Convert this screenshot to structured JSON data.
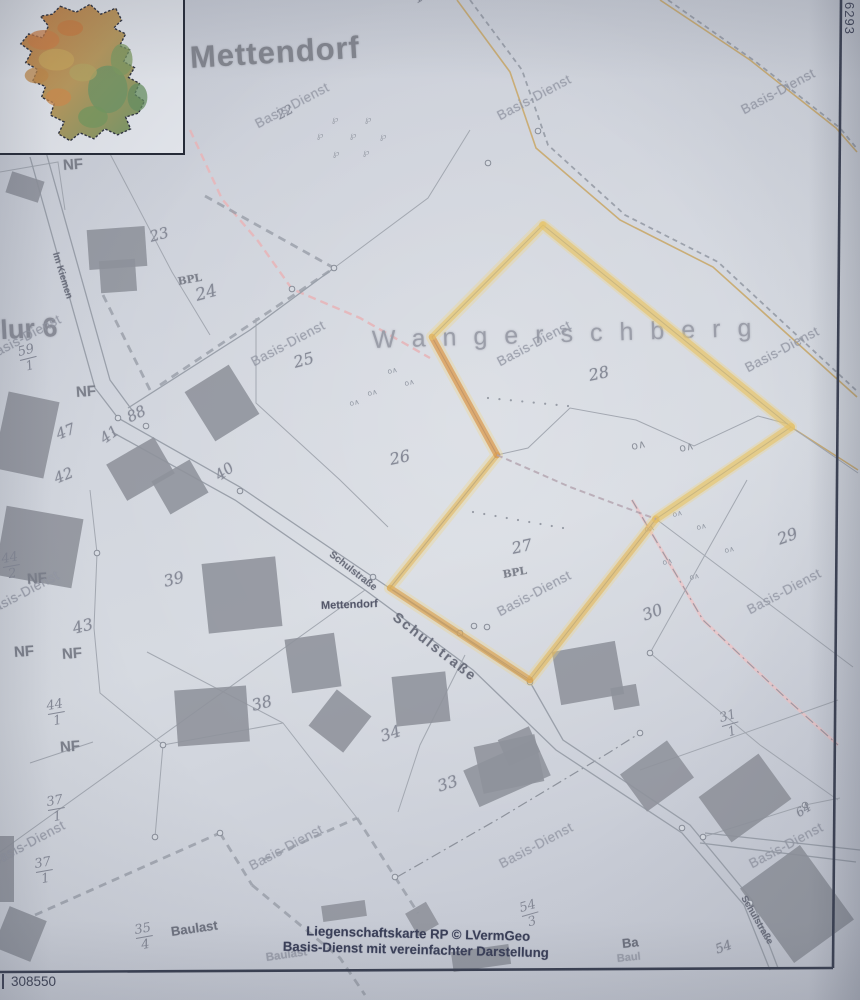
{
  "photo": {
    "width": 860,
    "height": 1000
  },
  "coords": {
    "bottom_left": "308550",
    "top_right": "6293"
  },
  "caption": {
    "line1": "Liegenschaftskarte RP © LVermGeo",
    "line2": "Basis-Dienst mit vereinfachter Darstellung"
  },
  "colors": {
    "paper": "#d2d6de",
    "frame": "#3a4052",
    "print": "#a3a8b1",
    "road": "#9aa0aa",
    "building": "#8e929b",
    "highlight_yellow": "#e7c468",
    "highlight_orange": "#d89044",
    "pink": "#ecc3c6",
    "tan": "#c9a86a",
    "caption_ink": "#3a3f58"
  },
  "labels": [
    {
      "t": "Mettendorf",
      "x": 190,
      "y": 42,
      "s": 31,
      "r": -3.5,
      "c": "title"
    },
    {
      "t": "Wangerschberg",
      "x": 372,
      "y": 328,
      "s": 25,
      "r": -1.8,
      "c": "area",
      "ls": 17
    },
    {
      "t": "Flur 6",
      "x": -16,
      "y": 318,
      "s": 27,
      "r": -3,
      "c": "flur"
    },
    {
      "t": "Mettendorf",
      "x": 321,
      "y": 601,
      "s": 11,
      "r": -2,
      "c": "village"
    },
    {
      "t": "Im Kiemen",
      "x": 55,
      "y": 248,
      "s": 9.5,
      "r": 73,
      "c": "street"
    },
    {
      "t": "Schulstraße",
      "x": 330,
      "y": 549,
      "s": 10,
      "r": 38,
      "c": "street"
    },
    {
      "t": "Schulstraße",
      "x": 395,
      "y": 608,
      "s": 14,
      "r": 38,
      "c": "street",
      "ls": 2
    },
    {
      "t": "Schulstraße",
      "x": 743,
      "y": 892,
      "s": 9.5,
      "r": 60,
      "c": "street"
    },
    {
      "t": "102",
      "x": 415,
      "y": -7,
      "s": 14,
      "r": -30,
      "c": "parcel"
    },
    {
      "t": "22",
      "x": 278,
      "y": 110,
      "s": 13,
      "r": -28,
      "c": "parcel"
    },
    {
      "t": "23",
      "x": 150,
      "y": 230,
      "s": 15,
      "r": -15,
      "c": "parcel"
    },
    {
      "t": "24",
      "x": 196,
      "y": 288,
      "s": 17,
      "r": -15,
      "c": "parcel"
    },
    {
      "t": "25",
      "x": 294,
      "y": 355,
      "s": 16,
      "r": -15,
      "c": "parcel"
    },
    {
      "t": "26",
      "x": 390,
      "y": 452,
      "s": 16,
      "r": -12,
      "c": "parcel"
    },
    {
      "t": "27",
      "x": 512,
      "y": 541,
      "s": 16,
      "r": -12,
      "c": "parcel"
    },
    {
      "t": "28",
      "x": 589,
      "y": 368,
      "s": 16,
      "r": -12,
      "c": "parcel"
    },
    {
      "t": "29",
      "x": 778,
      "y": 532,
      "s": 16,
      "r": -20,
      "c": "parcel"
    },
    {
      "t": "30",
      "x": 643,
      "y": 608,
      "s": 16,
      "r": -20,
      "c": "parcel"
    },
    {
      "t": "33",
      "x": 438,
      "y": 779,
      "s": 16,
      "r": -18,
      "c": "parcel"
    },
    {
      "t": "34",
      "x": 381,
      "y": 729,
      "s": 16,
      "r": -18,
      "c": "parcel"
    },
    {
      "t": "38",
      "x": 252,
      "y": 698,
      "s": 16,
      "r": -14,
      "c": "parcel"
    },
    {
      "t": "39",
      "x": 164,
      "y": 574,
      "s": 16,
      "r": -14,
      "c": "parcel"
    },
    {
      "t": "40",
      "x": 217,
      "y": 470,
      "s": 15,
      "r": -36,
      "c": "parcel"
    },
    {
      "t": "41",
      "x": 102,
      "y": 433,
      "s": 15,
      "r": -36,
      "c": "parcel"
    },
    {
      "t": "42",
      "x": 55,
      "y": 472,
      "s": 15,
      "r": -22,
      "c": "parcel"
    },
    {
      "t": "43",
      "x": 73,
      "y": 621,
      "s": 16,
      "r": -14,
      "c": "parcel"
    },
    {
      "t": "47",
      "x": 57,
      "y": 428,
      "s": 15,
      "r": -22,
      "c": "parcel"
    },
    {
      "t": "88",
      "x": 128,
      "y": 411,
      "s": 15,
      "r": -26,
      "c": "parcel"
    },
    {
      "t": "54",
      "x": 716,
      "y": 944,
      "s": 13,
      "r": -20,
      "c": "parcel"
    },
    {
      "t": "64",
      "x": 797,
      "y": 808,
      "s": 12,
      "r": -33,
      "c": "parcel"
    },
    {
      "t": "BPL",
      "x": 178,
      "y": 277,
      "s": 10.5,
      "r": -10,
      "c": "bpl"
    },
    {
      "t": "BPL",
      "x": 503,
      "y": 570,
      "s": 10.5,
      "r": -10,
      "c": "bpl"
    },
    {
      "t": "NF",
      "x": 63,
      "y": 158,
      "s": 15,
      "r": -4,
      "c": "nf"
    },
    {
      "t": "NF",
      "x": 76,
      "y": 385,
      "s": 15,
      "r": -4,
      "c": "nf"
    },
    {
      "t": "NF",
      "x": 27,
      "y": 572,
      "s": 15,
      "r": -4,
      "c": "nf"
    },
    {
      "t": "NF",
      "x": 14,
      "y": 645,
      "s": 15,
      "r": -4,
      "c": "nf"
    },
    {
      "t": "NF",
      "x": 62,
      "y": 647,
      "s": 15,
      "r": -4,
      "c": "nf"
    },
    {
      "t": "NF",
      "x": 60,
      "y": 740,
      "s": 15,
      "r": -4,
      "c": "nf"
    },
    {
      "t": "Baulast",
      "x": 171,
      "y": 925,
      "s": 13,
      "r": -8,
      "c": "baulast"
    },
    {
      "t": "Baulast",
      "x": 266,
      "y": 953,
      "s": 11.5,
      "r": -8,
      "c": "baulast-faint"
    },
    {
      "t": "Ba",
      "x": 622,
      "y": 937,
      "s": 13,
      "r": -6,
      "c": "baulast"
    },
    {
      "t": "Baul",
      "x": 617,
      "y": 954,
      "s": 11,
      "r": -6,
      "c": "baulast-faint"
    },
    {
      "t": "Basis-Dienst",
      "x": 256,
      "y": 118,
      "s": 13.5,
      "r": -28,
      "c": "wm"
    },
    {
      "t": "Basis-Dienst",
      "x": 498,
      "y": 110,
      "s": 13.5,
      "r": -28,
      "c": "wm"
    },
    {
      "t": "Basis-Dienst",
      "x": 742,
      "y": 104,
      "s": 13.5,
      "r": -28,
      "c": "wm"
    },
    {
      "t": "Basis-Dienst",
      "x": -12,
      "y": 350,
      "s": 13.5,
      "r": -28,
      "c": "wm"
    },
    {
      "t": "Basis-Dienst",
      "x": 252,
      "y": 356,
      "s": 13.5,
      "r": -28,
      "c": "wm"
    },
    {
      "t": "Basis-Dienst",
      "x": 498,
      "y": 356,
      "s": 13.5,
      "r": -28,
      "c": "wm"
    },
    {
      "t": "Basis-Dienst",
      "x": 746,
      "y": 362,
      "s": 13.5,
      "r": -28,
      "c": "wm"
    },
    {
      "t": "Basis-Dienst",
      "x": -14,
      "y": 606,
      "s": 13.5,
      "r": -28,
      "c": "wm"
    },
    {
      "t": "Basis-Dienst",
      "x": 498,
      "y": 606,
      "s": 13.5,
      "r": -28,
      "c": "wm"
    },
    {
      "t": "Basis-Dienst",
      "x": 748,
      "y": 604,
      "s": 13.5,
      "r": -28,
      "c": "wm"
    },
    {
      "t": "Basis-Dienst",
      "x": -8,
      "y": 856,
      "s": 13.5,
      "r": -28,
      "c": "wm"
    },
    {
      "t": "Basis-Dienst",
      "x": 250,
      "y": 860,
      "s": 13.5,
      "r": -28,
      "c": "wm"
    },
    {
      "t": "Basis-Dienst",
      "x": 500,
      "y": 858,
      "s": 13.5,
      "r": -28,
      "c": "wm"
    },
    {
      "t": "Basis-Dienst",
      "x": 750,
      "y": 858,
      "s": 13.5,
      "r": -28,
      "c": "wm"
    }
  ],
  "fractions": [
    {
      "n": "59",
      "d": "1",
      "x": 20,
      "y": 346,
      "r": -14
    },
    {
      "n": "44",
      "d": "2",
      "x": 3,
      "y": 553,
      "r": -10
    },
    {
      "n": "44",
      "d": "1",
      "x": 48,
      "y": 700,
      "r": -10
    },
    {
      "n": "37",
      "d": "1",
      "x": 48,
      "y": 796,
      "r": -10
    },
    {
      "n": "37",
      "d": "1",
      "x": 36,
      "y": 858,
      "r": -10
    },
    {
      "n": "35",
      "d": "4",
      "x": 136,
      "y": 924,
      "r": -10
    },
    {
      "n": "31",
      "d": "1",
      "x": 722,
      "y": 712,
      "r": -16
    },
    {
      "n": "54",
      "d": "3",
      "x": 522,
      "y": 902,
      "r": -16
    }
  ],
  "inset": {
    "box": [
      0,
      0,
      185,
      155
    ],
    "outline": "M 62,8 L 78,14 L 92,6 L 103,16 L 118,10 L 124,22 L 116,30 L 128,36 L 122,48 L 132,52 L 126,64 L 137,70 L 131,80 L 142,86 L 137,97 L 147,104 L 141,116 L 128,120 L 133,132 L 120,138 L 107,132 L 96,142 L 82,136 L 72,144 L 60,137 L 66,125 L 52,118 L 56,106 L 43,100 L 47,89 L 34,84 L 39,72 L 27,65 L 33,54 L 22,46 L 30,36 L 44,40 L 50,28 L 42,18 L 54,16 Z",
    "base_color": "#c2a866",
    "patches": [
      [
        45,
        42,
        16,
        10,
        "#cd7f46"
      ],
      [
        72,
        30,
        13,
        8,
        "#c97c40"
      ],
      [
        58,
        62,
        18,
        11,
        "#c9a75c"
      ],
      [
        38,
        78,
        12,
        8,
        "#c28a4a"
      ],
      [
        110,
        92,
        20,
        24,
        "#6e9566"
      ],
      [
        95,
        120,
        15,
        11,
        "#74985f"
      ],
      [
        124,
        62,
        11,
        16,
        "#7d9b62"
      ],
      [
        60,
        100,
        13,
        9,
        "#cf8c4e"
      ],
      [
        85,
        75,
        14,
        9,
        "#b5a563"
      ],
      [
        140,
        100,
        10,
        14,
        "#689061"
      ]
    ]
  },
  "geometry": {
    "frame": {
      "right": [
        841,
        0,
        833,
        968
      ],
      "bottom": [
        0,
        972,
        833,
        968
      ]
    },
    "roads": [
      [
        30,
        157,
        95,
        388,
        118,
        418
      ],
      [
        46,
        152,
        110,
        380,
        132,
        410
      ],
      [
        118,
        418,
        240,
        487,
        373,
        577,
        530,
        682,
        563,
        740,
        690,
        825,
        752,
        900,
        778,
        968
      ],
      [
        112,
        432,
        235,
        500,
        365,
        590,
        473,
        670,
        556,
        750,
        682,
        833,
        744,
        905,
        770,
        970
      ],
      [
        128,
        408,
        250,
        330,
        334,
        268
      ],
      [
        705,
        833,
        860,
        850
      ],
      [
        700,
        843,
        856,
        862
      ]
    ],
    "boundaries": [
      [
        0,
        172,
        58,
        162,
        65,
        210
      ],
      [
        108,
        150,
        172,
        272,
        210,
        335
      ],
      [
        256,
        318,
        256,
        403,
        340,
        480,
        388,
        527
      ],
      [
        334,
        268,
        428,
        198,
        470,
        130
      ],
      [
        791,
        427,
        858,
        473
      ],
      [
        656,
        519,
        853,
        667
      ],
      [
        747,
        480,
        650,
        653
      ],
      [
        650,
        653,
        760,
        745,
        838,
        800
      ],
      [
        0,
        852,
        365,
        590
      ],
      [
        90,
        490,
        97,
        553,
        94,
        628,
        100,
        693,
        163,
        745
      ],
      [
        163,
        745,
        155,
        837
      ],
      [
        163,
        745,
        283,
        723,
        357,
        818
      ],
      [
        147,
        652,
        283,
        723
      ],
      [
        30,
        763,
        93,
        742
      ],
      [
        465,
        655,
        420,
        745,
        398,
        812
      ],
      [
        640,
        770,
        838,
        700
      ],
      [
        703,
        837,
        805,
        805,
        840,
        798
      ],
      [
        497,
        455,
        528,
        448,
        570,
        408,
        636,
        420,
        694,
        446,
        758,
        416,
        788,
        424
      ]
    ],
    "dashdot": [
      [
        397,
        877,
        500,
        818,
        610,
        752,
        640,
        733
      ]
    ],
    "thick_dashed": [
      [
        205,
        196,
        334,
        268
      ],
      [
        103,
        295,
        150,
        390
      ],
      [
        160,
        385,
        334,
        268
      ],
      [
        35,
        915,
        220,
        833
      ],
      [
        220,
        833,
        252,
        885
      ],
      [
        252,
        885,
        340,
        958,
        365,
        995
      ],
      [
        263,
        860,
        357,
        818
      ],
      [
        357,
        818,
        395,
        877
      ],
      [
        395,
        877,
        418,
        913
      ]
    ],
    "gray_dashed": [
      [
        470,
        0,
        522,
        70,
        548,
        145,
        625,
        215,
        718,
        262,
        858,
        392
      ],
      [
        668,
        0,
        756,
        62,
        840,
        128,
        858,
        150
      ]
    ],
    "pink_dashed": [
      [
        190,
        130,
        222,
        199,
        258,
        241,
        292,
        289,
        360,
        318,
        430,
        358
      ]
    ],
    "pink_dashdot": [
      [
        632,
        500,
        703,
        620,
        790,
        702,
        838,
        745
      ]
    ],
    "tan": [
      [
        457,
        0,
        510,
        72,
        536,
        148,
        620,
        220,
        713,
        267,
        857,
        397
      ],
      [
        660,
        0,
        750,
        60,
        836,
        128,
        857,
        152
      ],
      [
        791,
        427,
        858,
        470
      ]
    ],
    "highlight": {
      "polygon": [
        543,
        225,
        791,
        427,
        656,
        519,
        530,
        680,
        390,
        588,
        497,
        455,
        432,
        337
      ],
      "edges": [
        {
          "p": [
            543,
            225,
            791,
            427
          ],
          "col": "rgba(231,196,104,0.62)",
          "w": 8
        },
        {
          "p": [
            791,
            427,
            656,
            519
          ],
          "col": "rgba(231,196,104,0.62)",
          "w": 8
        },
        {
          "p": [
            656,
            519,
            530,
            680
          ],
          "col": "rgba(227,184,92,0.60)",
          "w": 7
        },
        {
          "p": [
            530,
            680,
            390,
            588
          ],
          "col": "rgba(217,155,70,0.60)",
          "w": 6.5
        },
        {
          "p": [
            390,
            588,
            497,
            455
          ],
          "col": "rgba(226,180,88,0.55)",
          "w": 6
        },
        {
          "p": [
            497,
            455,
            432,
            337
          ],
          "col": "rgba(216,144,68,0.65)",
          "w": 6.5
        },
        {
          "p": [
            432,
            337,
            543,
            225
          ],
          "col": "rgba(231,196,104,0.60)",
          "w": 6.5
        }
      ],
      "shared_edge": [
        497,
        455,
        570,
        487,
        656,
        519
      ]
    },
    "buildings": [
      [
        88,
        228,
        58,
        40,
        -4
      ],
      [
        100,
        260,
        36,
        32,
        -4
      ],
      [
        8,
        176,
        34,
        22,
        18
      ],
      [
        196,
        374,
        52,
        58,
        -32
      ],
      [
        0,
        396,
        52,
        78,
        12
      ],
      [
        113,
        448,
        55,
        42,
        -30
      ],
      [
        158,
        468,
        44,
        38,
        -30
      ],
      [
        0,
        512,
        78,
        70,
        10
      ],
      [
        205,
        560,
        74,
        70,
        -6
      ],
      [
        288,
        636,
        50,
        54,
        -8
      ],
      [
        176,
        688,
        72,
        56,
        -4
      ],
      [
        318,
        698,
        44,
        46,
        38
      ],
      [
        394,
        674,
        54,
        50,
        -6
      ],
      [
        478,
        740,
        62,
        48,
        -12
      ],
      [
        556,
        646,
        64,
        54,
        -10
      ],
      [
        612,
        686,
        26,
        22,
        -10
      ],
      [
        468,
        753,
        78,
        40,
        -24
      ],
      [
        502,
        732,
        34,
        28,
        -24
      ],
      [
        628,
        753,
        58,
        46,
        -36
      ],
      [
        708,
        770,
        74,
        56,
        -36
      ],
      [
        760,
        858,
        74,
        92,
        -36
      ],
      [
        0,
        836,
        14,
        66,
        0
      ],
      [
        0,
        912,
        40,
        44,
        22
      ],
      [
        410,
        906,
        24,
        26,
        -30
      ],
      [
        452,
        948,
        58,
        20,
        -8
      ],
      [
        322,
        903,
        44,
        16,
        -8
      ]
    ],
    "circles": [
      [
        488,
        163
      ],
      [
        538,
        131
      ],
      [
        334,
        268
      ],
      [
        292,
        289
      ],
      [
        118,
        418
      ],
      [
        146,
        426
      ],
      [
        240,
        491
      ],
      [
        373,
        577
      ],
      [
        460,
        633
      ],
      [
        474,
        626
      ],
      [
        487,
        627
      ],
      [
        530,
        682
      ],
      [
        682,
        828
      ],
      [
        703,
        837
      ],
      [
        640,
        733
      ],
      [
        97,
        553
      ],
      [
        163,
        745
      ],
      [
        155,
        837
      ],
      [
        220,
        833
      ],
      [
        395,
        877
      ],
      [
        650,
        653
      ],
      [
        805,
        805
      ],
      [
        750,
        903
      ]
    ],
    "dot_rows": [
      {
        "a": [
          488,
          398
        ],
        "b": [
          568,
          406
        ],
        "n": 8
      },
      {
        "a": [
          473,
          512
        ],
        "b": [
          563,
          528
        ],
        "n": 9
      }
    ],
    "trees_p": [
      [
        332,
        122
      ],
      [
        365,
        122
      ],
      [
        317,
        138
      ],
      [
        350,
        138
      ],
      [
        380,
        139
      ],
      [
        333,
        156
      ],
      [
        363,
        155
      ]
    ],
    "trees_small": [
      [
        388,
        374
      ],
      [
        405,
        386
      ],
      [
        368,
        396
      ],
      [
        350,
        406
      ],
      [
        645,
        532
      ],
      [
        673,
        517
      ],
      [
        697,
        530
      ],
      [
        663,
        565
      ],
      [
        690,
        580
      ],
      [
        725,
        553
      ]
    ],
    "trees_big": [
      [
        632,
        450
      ],
      [
        680,
        452
      ]
    ]
  }
}
